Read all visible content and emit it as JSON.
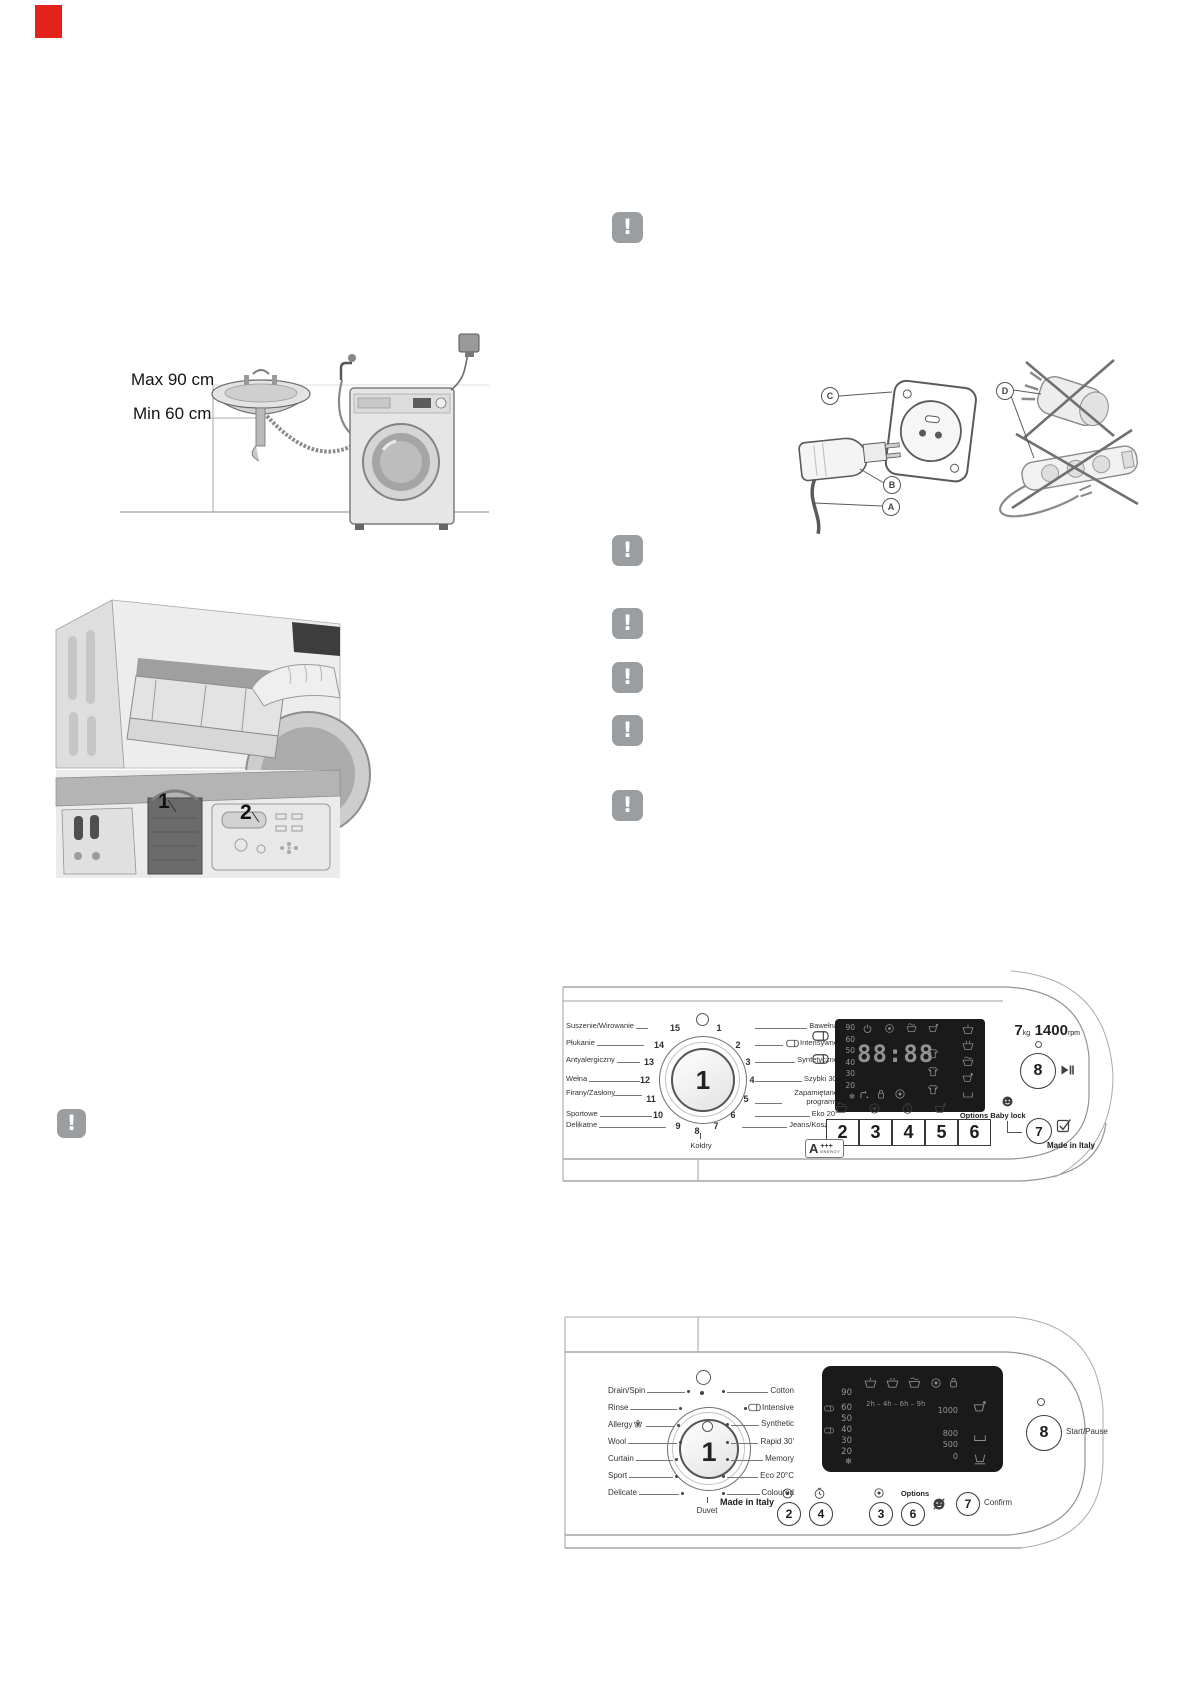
{
  "page": {
    "corner_mark_color": "#e3231b"
  },
  "install_figure": {
    "max_label": "Max 90 cm",
    "min_label": "Min 60 cm"
  },
  "drawer_figure": {
    "compartment_1": "1",
    "compartment_2": "2"
  },
  "plug_figure": {
    "label_a": "A",
    "label_b": "B",
    "label_c": "C",
    "label_d": "D"
  },
  "warning": {
    "glyph": "!"
  },
  "panel_pl": {
    "dial_value": "1",
    "programs_left": [
      {
        "num": "15",
        "label": "Suszenie/Wirowanie"
      },
      {
        "num": "14",
        "label": "Płukanie"
      },
      {
        "num": "13",
        "label": "Antyalergiczny"
      },
      {
        "num": "12",
        "label": "Wełna"
      },
      {
        "num": "11",
        "label": "Firany/Zasłony"
      },
      {
        "num": "10",
        "label": "Sportowe"
      },
      {
        "num": "9",
        "label": "Delikatne"
      }
    ],
    "programs_right": [
      {
        "num": "1",
        "label": "Bawełna"
      },
      {
        "num": "2",
        "label": "Intensywne"
      },
      {
        "num": "3",
        "label": "Syntetyczne"
      },
      {
        "num": "4",
        "label": "Szybki 30'"
      },
      {
        "num": "5",
        "label": "Zapamiętane programy"
      },
      {
        "num": "6",
        "label": "Eko 20°"
      },
      {
        "num": "7",
        "label": "Jeans/Koszule"
      }
    ],
    "program_bottom": {
      "num": "8",
      "label": "Kołdry"
    },
    "display": {
      "temps": [
        "90",
        "60",
        "50",
        "40",
        "30",
        "20",
        "❄"
      ],
      "time": "88:88"
    },
    "buttons": [
      "2",
      "3",
      "4",
      "5",
      "6"
    ],
    "options_label": "Options",
    "baby_lock_label": "Baby lock",
    "confirm_button": "7",
    "start_button": "8",
    "capacity_value": "7",
    "capacity_unit": "kg",
    "spin_value": "1400",
    "spin_unit": "rpm",
    "energy_class": "A",
    "energy_plus": "+++",
    "energy_word": "energy",
    "made_in": "Made in Italy"
  },
  "panel_en": {
    "dial_value": "1",
    "programs_left": [
      "Drain/Spin",
      "Rinse",
      "Allergy",
      "Wool",
      "Curtain",
      "Sport",
      "Delicate"
    ],
    "programs_right": [
      "Cotton",
      "Intensive",
      "Synthetic",
      "Rapid 30'",
      "Memory",
      "Eco 20°C",
      "Coloured"
    ],
    "program_bottom": "Duvet",
    "display": {
      "temps": [
        "90",
        "60",
        "50",
        "40",
        "30",
        "20",
        "❄"
      ],
      "delay_times": "2h – 4h – 6h – 9h",
      "spin_speeds": [
        "1000",
        "800",
        "500",
        "0"
      ]
    },
    "buttons": [
      "2",
      "4",
      "3",
      "6"
    ],
    "options_label": "Options",
    "confirm_button": "7",
    "confirm_label": "Confirm",
    "start_button": "8",
    "start_pause_label": "Start/Pause",
    "made_in": "Made in Italy"
  }
}
